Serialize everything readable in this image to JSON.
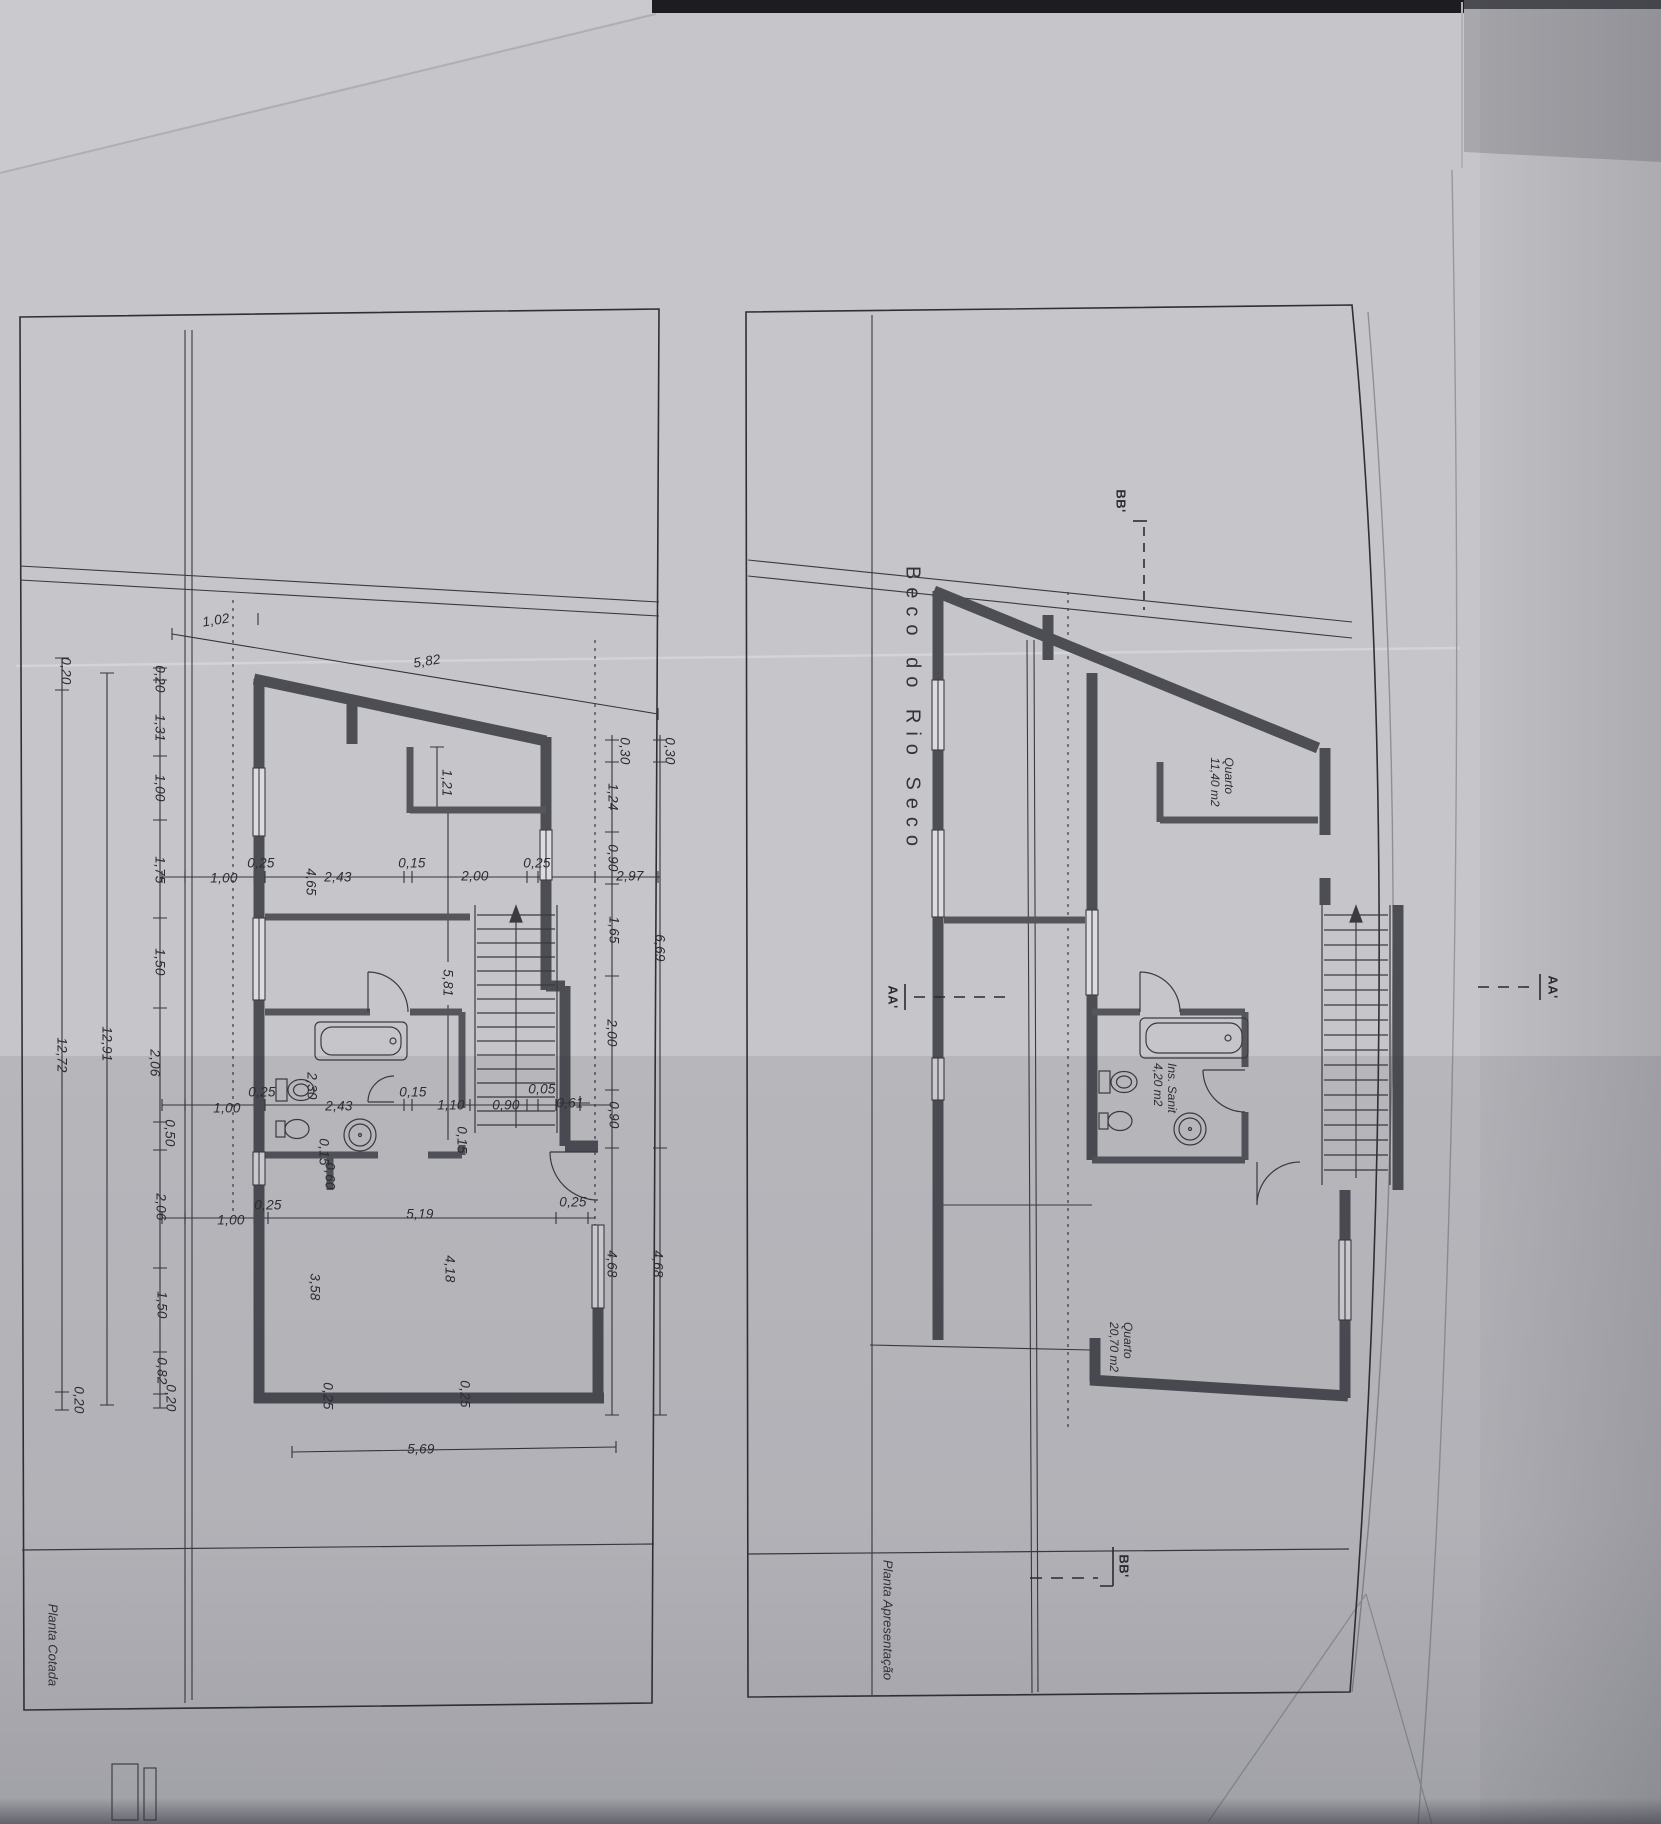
{
  "sheet": {
    "street_title": "Beco do Rio Seco",
    "plan_left_title": "Planta Cotada",
    "plan_right_title": "Planta Apresentação"
  },
  "rooms": {
    "quarto1": {
      "name": "Quarto",
      "area": "11,40 m2"
    },
    "sanit": {
      "name": "Ins. Sanit",
      "area": "4,20 m2"
    },
    "quarto2": {
      "name": "Quarto",
      "area": "20,70 m2"
    }
  },
  "sections": {
    "bb_top": "BB'",
    "bb_bottom": "BB'",
    "aa_left": "AA'",
    "aa_right": "AA'"
  },
  "dim_labels": [
    {
      "t": "0,20",
      "x": 66,
      "y": 671,
      "r": 90
    },
    {
      "t": "12,72",
      "x": 62,
      "y": 1055,
      "r": 90
    },
    {
      "t": "0,20",
      "x": 79,
      "y": 1400,
      "r": 90
    },
    {
      "t": "12,91",
      "x": 107,
      "y": 1044,
      "r": 90
    },
    {
      "t": "0,20",
      "x": 160,
      "y": 679,
      "r": 90
    },
    {
      "t": "1,31",
      "x": 160,
      "y": 728,
      "r": 90
    },
    {
      "t": "1,00",
      "x": 160,
      "y": 788,
      "r": 90
    },
    {
      "t": "1,75",
      "x": 160,
      "y": 870,
      "r": 90
    },
    {
      "t": "1,50",
      "x": 160,
      "y": 962,
      "r": 90
    },
    {
      "t": "2,06",
      "x": 155,
      "y": 1063,
      "r": 90
    },
    {
      "t": "0,50",
      "x": 170,
      "y": 1133,
      "r": 90
    },
    {
      "t": "2,06",
      "x": 161,
      "y": 1207,
      "r": 90
    },
    {
      "t": "1,50",
      "x": 162,
      "y": 1305,
      "r": 90
    },
    {
      "t": "0,82",
      "x": 162,
      "y": 1371,
      "r": 90
    },
    {
      "t": "0,20",
      "x": 171,
      "y": 1398,
      "r": 90
    },
    {
      "t": "1,02",
      "x": 216,
      "y": 620,
      "r": -9
    },
    {
      "t": "5,82",
      "x": 427,
      "y": 661,
      "r": -9
    },
    {
      "t": "1,00",
      "x": 224,
      "y": 878,
      "r": 0
    },
    {
      "t": "0,25",
      "x": 261,
      "y": 863,
      "r": 0
    },
    {
      "t": "4,65",
      "x": 311,
      "y": 882,
      "r": 90
    },
    {
      "t": "2,43",
      "x": 338,
      "y": 877,
      "r": 0
    },
    {
      "t": "0,15",
      "x": 412,
      "y": 863,
      "r": 0
    },
    {
      "t": "2,00",
      "x": 475,
      "y": 876,
      "r": 0
    },
    {
      "t": "0,25",
      "x": 537,
      "y": 863,
      "r": 0
    },
    {
      "t": "2,97",
      "x": 630,
      "y": 876,
      "r": 0
    },
    {
      "t": "1,00",
      "x": 227,
      "y": 1108,
      "r": 0
    },
    {
      "t": "0,25",
      "x": 262,
      "y": 1092,
      "r": 0
    },
    {
      "t": "2,30",
      "x": 312,
      "y": 1086,
      "r": 90
    },
    {
      "t": "2,43",
      "x": 339,
      "y": 1106,
      "r": 0
    },
    {
      "t": "0,15",
      "x": 413,
      "y": 1092,
      "r": 0
    },
    {
      "t": "1,10",
      "x": 451,
      "y": 1105,
      "r": 0
    },
    {
      "t": "0,90",
      "x": 506,
      "y": 1105,
      "r": 0
    },
    {
      "t": "0,05",
      "x": 542,
      "y": 1089,
      "r": 0
    },
    {
      "t": "0,61",
      "x": 570,
      "y": 1103,
      "r": 0
    },
    {
      "t": "1,00",
      "x": 231,
      "y": 1220,
      "r": 0
    },
    {
      "t": "0,25",
      "x": 268,
      "y": 1205,
      "r": 0
    },
    {
      "t": "5,19",
      "x": 420,
      "y": 1214,
      "r": 0
    },
    {
      "t": "1,21",
      "x": 447,
      "y": 783,
      "r": 90
    },
    {
      "t": "5,81",
      "x": 448,
      "y": 983,
      "r": 90
    },
    {
      "t": "0,15",
      "x": 462,
      "y": 1140,
      "r": 90
    },
    {
      "t": "0,15",
      "x": 324,
      "y": 1152,
      "r": 90
    },
    {
      "t": "0,60",
      "x": 330,
      "y": 1176,
      "r": 90
    },
    {
      "t": "3,58",
      "x": 315,
      "y": 1287,
      "r": 90
    },
    {
      "t": "4,18",
      "x": 450,
      "y": 1269,
      "r": 90
    },
    {
      "t": "0,25",
      "x": 328,
      "y": 1396,
      "r": 90
    },
    {
      "t": "0,25",
      "x": 465,
      "y": 1394,
      "r": 90
    },
    {
      "t": "5,69",
      "x": 421,
      "y": 1449,
      "r": 0
    },
    {
      "t": "0,30",
      "x": 625,
      "y": 751,
      "r": 90
    },
    {
      "t": "0,30",
      "x": 670,
      "y": 751,
      "r": 90
    },
    {
      "t": "1,24",
      "x": 613,
      "y": 797,
      "r": 90
    },
    {
      "t": "0,90",
      "x": 613,
      "y": 858,
      "r": 90
    },
    {
      "t": "1,65",
      "x": 614,
      "y": 930,
      "r": 90
    },
    {
      "t": "2,00",
      "x": 612,
      "y": 1033,
      "r": 90
    },
    {
      "t": "0,90",
      "x": 614,
      "y": 1115,
      "r": 90
    },
    {
      "t": "4,68",
      "x": 612,
      "y": 1264,
      "r": 90
    },
    {
      "t": "6,69",
      "x": 660,
      "y": 948,
      "r": 90
    },
    {
      "t": "4,68",
      "x": 658,
      "y": 1264,
      "r": 90
    },
    {
      "t": "0,25",
      "x": 573,
      "y": 1202,
      "r": 0
    }
  ]
}
